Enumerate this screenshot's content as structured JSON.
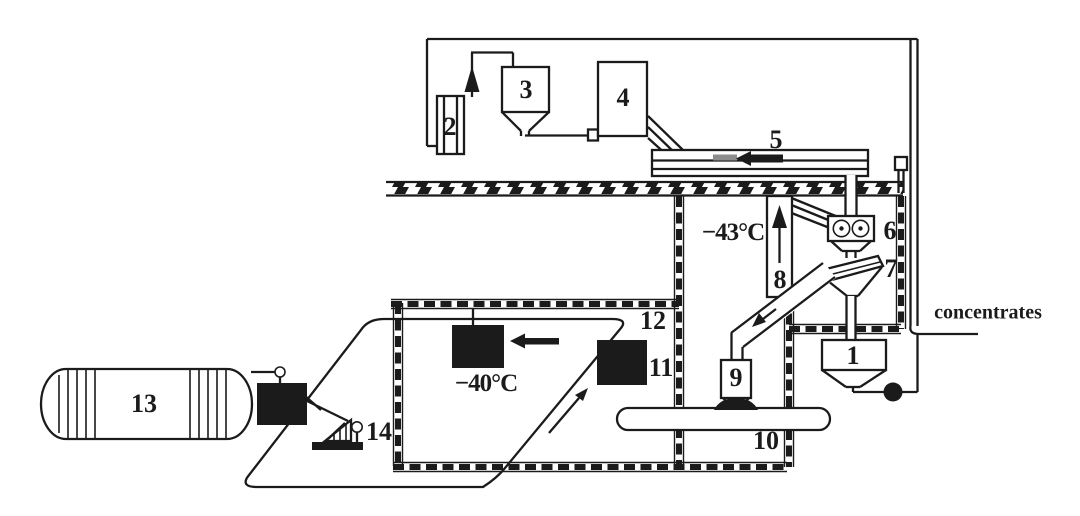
{
  "colors": {
    "ink": "#1b1b1b",
    "background": "#ffffff",
    "arrow_gray": "#8c8c8c"
  },
  "labels": {
    "1": "1",
    "2": "2",
    "3": "3",
    "4": "4",
    "5": "5",
    "6": "6",
    "7": "7",
    "8": "8",
    "9": "9",
    "10": "10",
    "11": "11",
    "12": "12",
    "13": "13",
    "14": "14"
  },
  "annotations": {
    "temp_right_chamber": "−43°C",
    "temp_left_chamber": "−40°C",
    "concentrates_label": "concentrates"
  }
}
